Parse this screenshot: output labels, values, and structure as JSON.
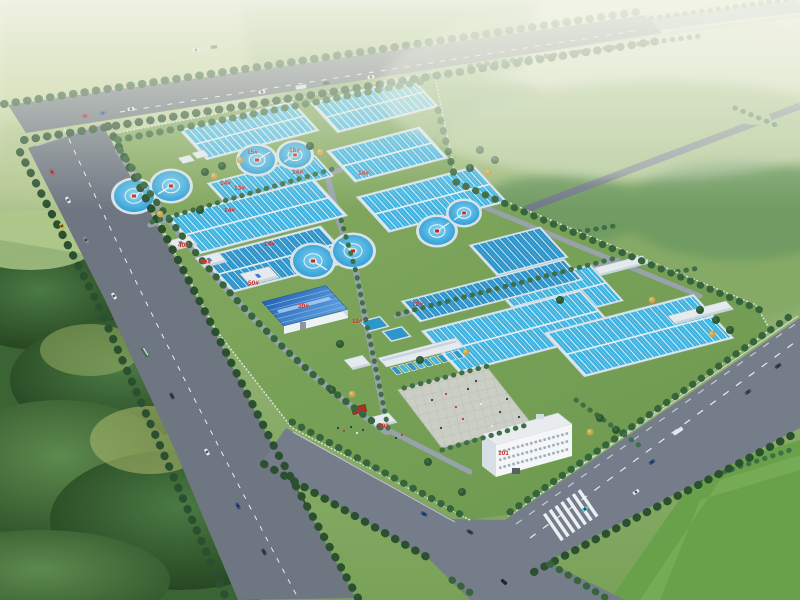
{
  "scene": {
    "description": "Aerial 3D rendering of a municipal water / sewage treatment plant campus: rows of blue rectangular treatment basins, eight circular clarifiers, service buildings, an administration building with entrance plaza and gatehouse, tree-lined perimeter roads with traffic, surrounded by farmland, woods and a distant river"
  },
  "labels": {
    "basins": [
      "13#",
      "14#",
      "14#",
      "14#",
      "14#",
      "14#",
      "12#",
      "11#"
    ],
    "tanks": [
      "15#",
      "16#"
    ],
    "buildings": {
      "b40": "40#",
      "b20": "20#",
      "b50": "50#",
      "b30": "30#",
      "admin": "101",
      "gate": "102"
    }
  },
  "counts": {
    "circular_clarifiers": 8,
    "rectangular_basin_groups": 12,
    "labeled_small_buildings": 4,
    "vehicles_visible": 28
  },
  "colors": {
    "basin_water": "#3FB2E0",
    "basin_water_deep": "#2E93C9",
    "blue_roof": "#3A7CC8",
    "white_building": "#F3F6F8",
    "asphalt_road": "#6E7682",
    "lane_marking": "#EDF1F3",
    "lawn": "#7CA35B",
    "tree_dark": "#2B5030",
    "autumn_tree": "#C8A452",
    "label_red": "#C8281E",
    "plaza_paving": "#CBCEC4",
    "river": "#9AAFC0"
  }
}
